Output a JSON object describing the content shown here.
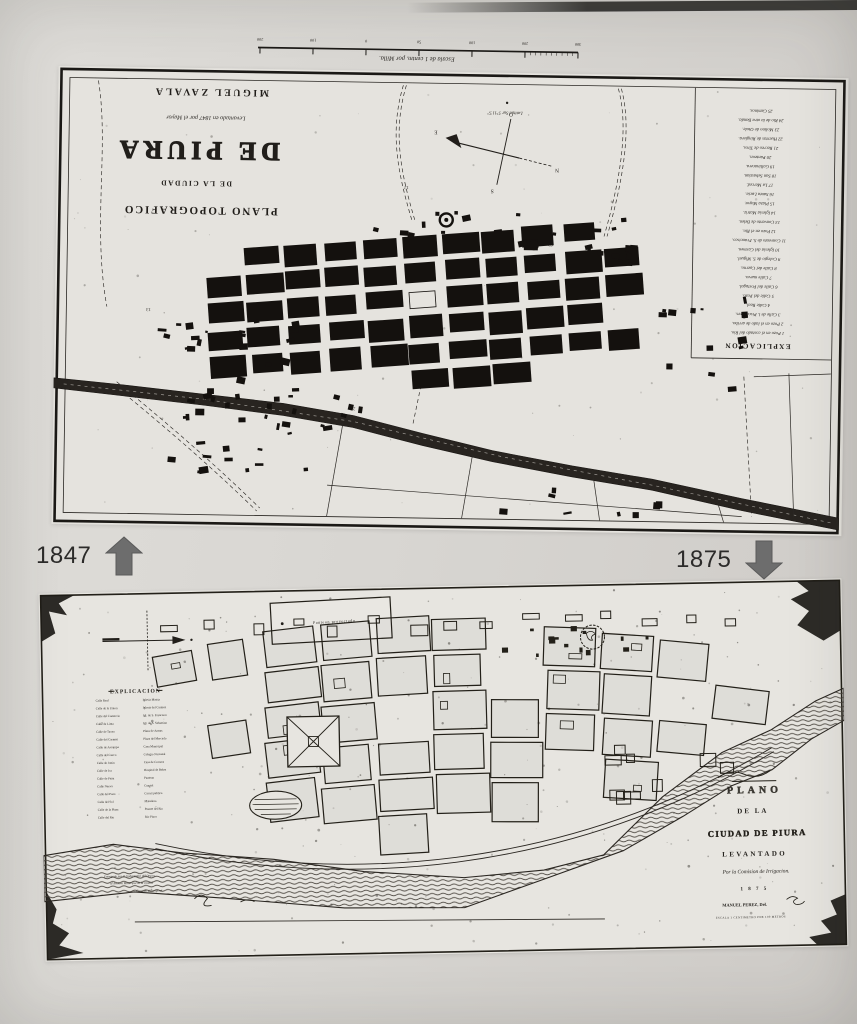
{
  "photo": {
    "years": {
      "top": "1847",
      "bottom": "1875"
    }
  },
  "top_map": {
    "scale_caption": "Escala de 1 centm. por Milla.",
    "scale_ticks": [
      "300",
      "200",
      "100",
      "50",
      "0",
      "100",
      "200"
    ],
    "latitude_note": "Latitud Sur 5°11'5''",
    "title_block": {
      "author": "MIGUEL ZAVALA",
      "commission": "Levantado en 1847 por el Mayor",
      "title": "DE PIURA",
      "subtitle": "DE LA CIUDAD",
      "kind": "PLANO TOPOGRAFICO"
    },
    "compass": {
      "n": "N",
      "s": "S",
      "e": "E",
      "o": "O"
    },
    "road_numbers": [
      "12",
      "13",
      "21",
      "62"
    ],
    "legend": {
      "header": "EXPLICACION",
      "items": [
        "Pozo en el costado del Rio.",
        "Pozo en el lado de arriba.",
        "Calle de l. Piscadores.",
        "Calle Real.",
        "Calle del Pozo.",
        "Calle del Portugal.",
        "Calle nueva.",
        "Calle del Cuerno.",
        "Colegio de S. Miguel.",
        "Iglesia del Carmen.",
        "Convento de S. Francisco.",
        "Pozo en el Rio.",
        "Convento de Belen.",
        "Iglesia Matriz.",
        "Plaza Mayor.",
        "Santa Lucia.",
        "La Merced.",
        "San Sebastian.",
        "Gallinacera.",
        "Panteon.",
        "Recreo de Tiros.",
        "Huertas de Ringlera.",
        "Molino de Otole.",
        "Rio de la otra Banda.",
        "Caminos."
      ]
    }
  },
  "bottom_map": {
    "cartouche_label": "Panteon proyectado",
    "legend": {
      "header": "EXPLICACION",
      "col1": [
        "Calle Real",
        "Calle de la Union",
        "Calle del Comercio",
        "Calle de Lima",
        "Calle de Tacna",
        "Calle del Carmen",
        "Calle de Arequipa",
        "Calle del Cuzco",
        "Calle de Junin",
        "Calle de Ica",
        "Calle de Paita",
        "Calle Nueva",
        "Calle del Pozo",
        "Calle del Sol",
        "Calle de la Plaza",
        "Calle del Rio"
      ],
      "col2": [
        "Iglesia Matriz",
        "Iglesia del Carmen",
        "Igl. de S. Francisco",
        "Igl. de S. Sebastian",
        "Plaza de Armas",
        "Plaza del Mercado",
        "Casa Municipal",
        "Colegio Nacional",
        "Casa de Correos",
        "Hospital de Belen",
        "Panteon",
        "Cuartel",
        "Carcel publica",
        "Matadero",
        "Puente del Rio",
        "Rio Piura"
      ]
    },
    "title_block": {
      "ornament": "PLANO",
      "line2": "DE LA",
      "line3": "CIUDAD DE PIURA",
      "line4": "LEVANTADO",
      "line5": "Por la Comision de Irrigacion.",
      "line6": "1 8 7 5",
      "line7": "MANUEL PEREZ, Del.",
      "line8": "ESCALA 1 CENTIMETRO POR 100 METROS"
    },
    "notes": [
      "Entregado por el Gobernador del Dep.to",
      "al Archivo Municipal de la ciudad.",
      "Copiado del original."
    ]
  }
}
